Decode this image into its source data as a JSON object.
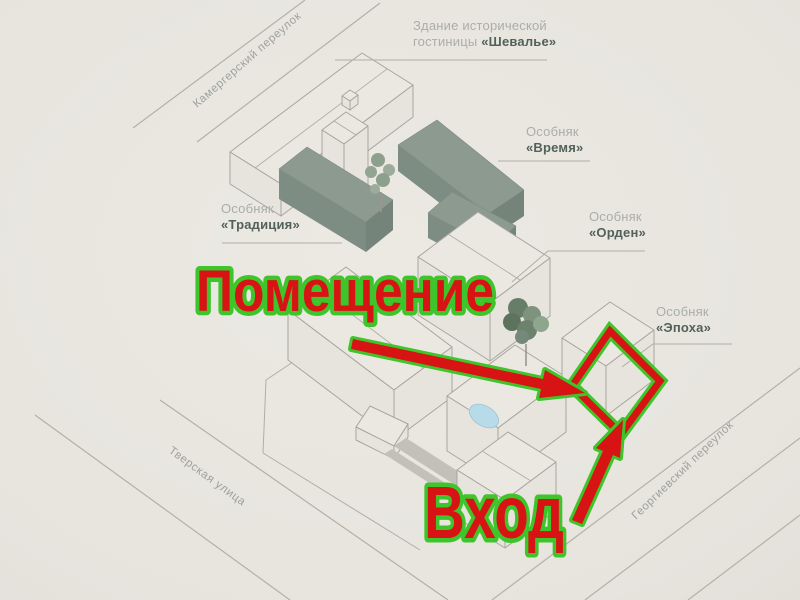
{
  "scene": {
    "background_color": "#e7e4de",
    "line_color": "#b4b0a9",
    "building_fill": "#ebe8e2",
    "green_building_top": "#8d9a8f",
    "green_building_side": "#7e8d84",
    "pond_color": "#b7dbe9",
    "path_color": "#c3c0b9",
    "label_light_color": "#a9aea7",
    "label_dark_color": "#52615a"
  },
  "streets": [
    {
      "name": "Камергерский переулок"
    },
    {
      "name": "Тверская улица"
    },
    {
      "name": "Георгиевский переулок"
    }
  ],
  "buildings": [
    {
      "line1": "Здание исторической",
      "line2_normal": "гостиницы ",
      "line2_bold": "«Шевалье»"
    },
    {
      "line1": "Особняк",
      "line2_bold": "«Время»"
    },
    {
      "line1": "Особняк",
      "line2_bold": "«Традиция»"
    },
    {
      "line1": "Особняк",
      "line2_bold": "«Орден»"
    },
    {
      "line1": "Особняк",
      "line2_bold": "«Эпоха»"
    }
  ],
  "annotations": {
    "premises_label": "Помещение",
    "entrance_label": "Вход",
    "highlight_red": "#d81313",
    "outline_green": "#3ec52b"
  }
}
